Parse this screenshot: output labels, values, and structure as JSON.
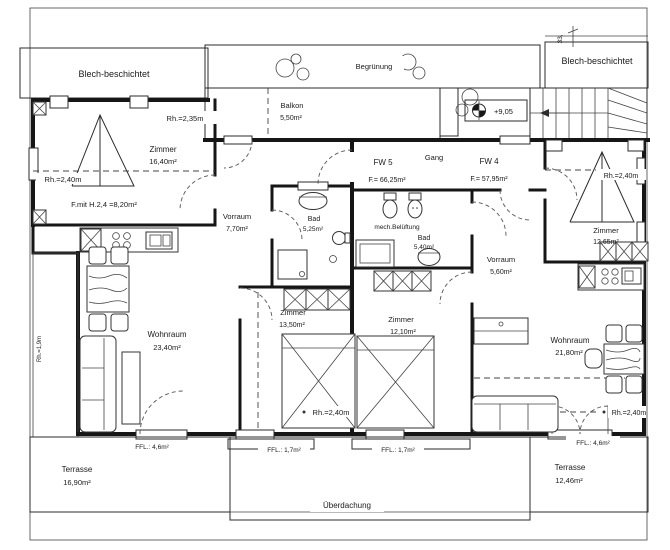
{
  "sheet": {
    "canopy_left": "Blech-beschichtet",
    "canopy_right": "Blech-beschichtet",
    "dim_top_right": "33,",
    "begruenung": "Begrünung",
    "balkon_name": "Balkon",
    "balkon_area": "5,50m²",
    "elevation": "+9,05",
    "ueberdachung": "Überdachung"
  },
  "apartments": {
    "fw5_name": "FW 5",
    "fw5_area": "F.= 66,25m²",
    "gang": "Gang",
    "fw4_name": "FW 4",
    "fw4_area": "F.= 57,95m²"
  },
  "rooms": {
    "zimmer_nw_name": "Zimmer",
    "zimmer_nw_area": "16,40m²",
    "rh_235": "Rh.=2,35m",
    "rh_240_nw": "Rh.=2,40m",
    "f_mit": "F.mit H.2,4 =8,20m²",
    "vorraum5_name": "Vorraum",
    "vorraum5_area": "7,70m²",
    "bad5_name": "Bad",
    "bad5_area": "5,25m²",
    "mech_belueftung": "mech.Belüftung",
    "bad4_name": "Bad",
    "bad4_area": "5,40m²",
    "vorraum4_name": "Vorraum",
    "vorraum4_area": "5,60m²",
    "zimmer_ne_name": "Zimmer",
    "zimmer_ne_area": "12,65m²",
    "rh_240_ne": "Rh.=2,40m",
    "wohnraum5_name": "Wohnraum",
    "wohnraum5_area": "23,40m²",
    "zimmer_s5_name": "Zimmer",
    "zimmer_s5_area": "13,50m²",
    "rh_240_s5": "Rh.=2,40m",
    "zimmer_s4_name": "Zimmer",
    "zimmer_s4_area": "12,10m²",
    "wohnraum4_name": "Wohnraum",
    "wohnraum4_area": "21,80m²",
    "rh_240_s4": "Rh.=2,40m",
    "rh_19_left": "Rh.=1,9m"
  },
  "outdoor": {
    "ffl_left": "FFL.: 4,6m²",
    "ffl_mid1": "FFL.: 1,7m²",
    "ffl_mid2": "FFL.: 1,7m²",
    "ffl_right": "FFL.: 4,6m²",
    "terrasse_left_name": "Terrasse",
    "terrasse_left_area": "16,90m²",
    "terrasse_right_name": "Terrasse",
    "terrasse_right_area": "12,46m²"
  }
}
